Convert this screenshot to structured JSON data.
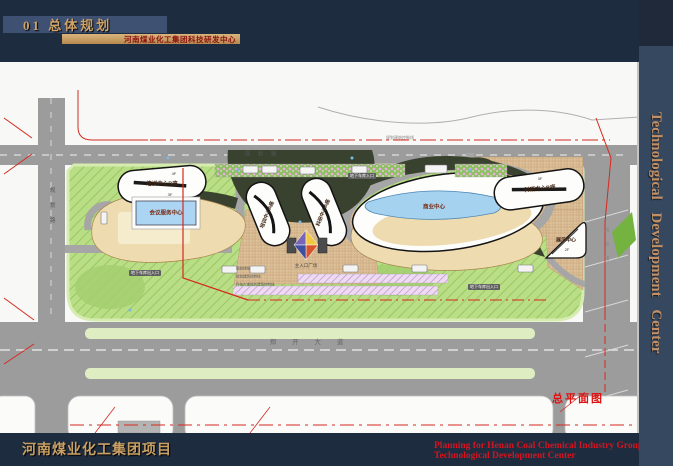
{
  "header": {
    "section_title": "01  总体规划",
    "subtitle": "河南煤业化工集团科技研发中心"
  },
  "sidebar": {
    "vertical_title": "Technological Development Center"
  },
  "footer": {
    "project": "河南煤业化工集团项目",
    "caption_en_1": "Planning for Henan Coal Chemical Industry Group",
    "caption_en_2": "Technological Development Center"
  },
  "plan": {
    "caption": "总平面图",
    "buildings": {
      "training_b": "培训中心B座",
      "training_b_floors": "4F",
      "conference": "会议服务中心",
      "conference_floors": "3F",
      "training_a": "培训中心A座",
      "research_a": "科研中心A座",
      "commercial": "商业中心",
      "research_b": "科研中心B座",
      "research_b_floors": "3F",
      "exhibition": "展示中心",
      "exhibition_floors": "2F"
    },
    "plaza_label": "主入口广场",
    "roads": {
      "north": "规 划 路",
      "west": "规 划 路",
      "east": "规 划 路",
      "south": "郑 开 大 道"
    },
    "badges": {
      "garage_1": "地下车库入口",
      "garage_2": "地下车库出入口",
      "garage_3": "地下车库出入口"
    },
    "annotations": {
      "green_line": "规划绿线",
      "control_line": "规划建筑控制线",
      "road_control_line": "科技大道规划建筑控制线",
      "north_control": "规划建筑控制线"
    },
    "colors": {
      "site_green": "#b9de85",
      "road_gray": "#9c9c9c",
      "boundary_red": "#d42a20",
      "podium_tan": "#eedcb0",
      "water_blue": "#a4d2ef",
      "accent_gold": "#c9a064",
      "navy": "#1e2c3f"
    }
  }
}
